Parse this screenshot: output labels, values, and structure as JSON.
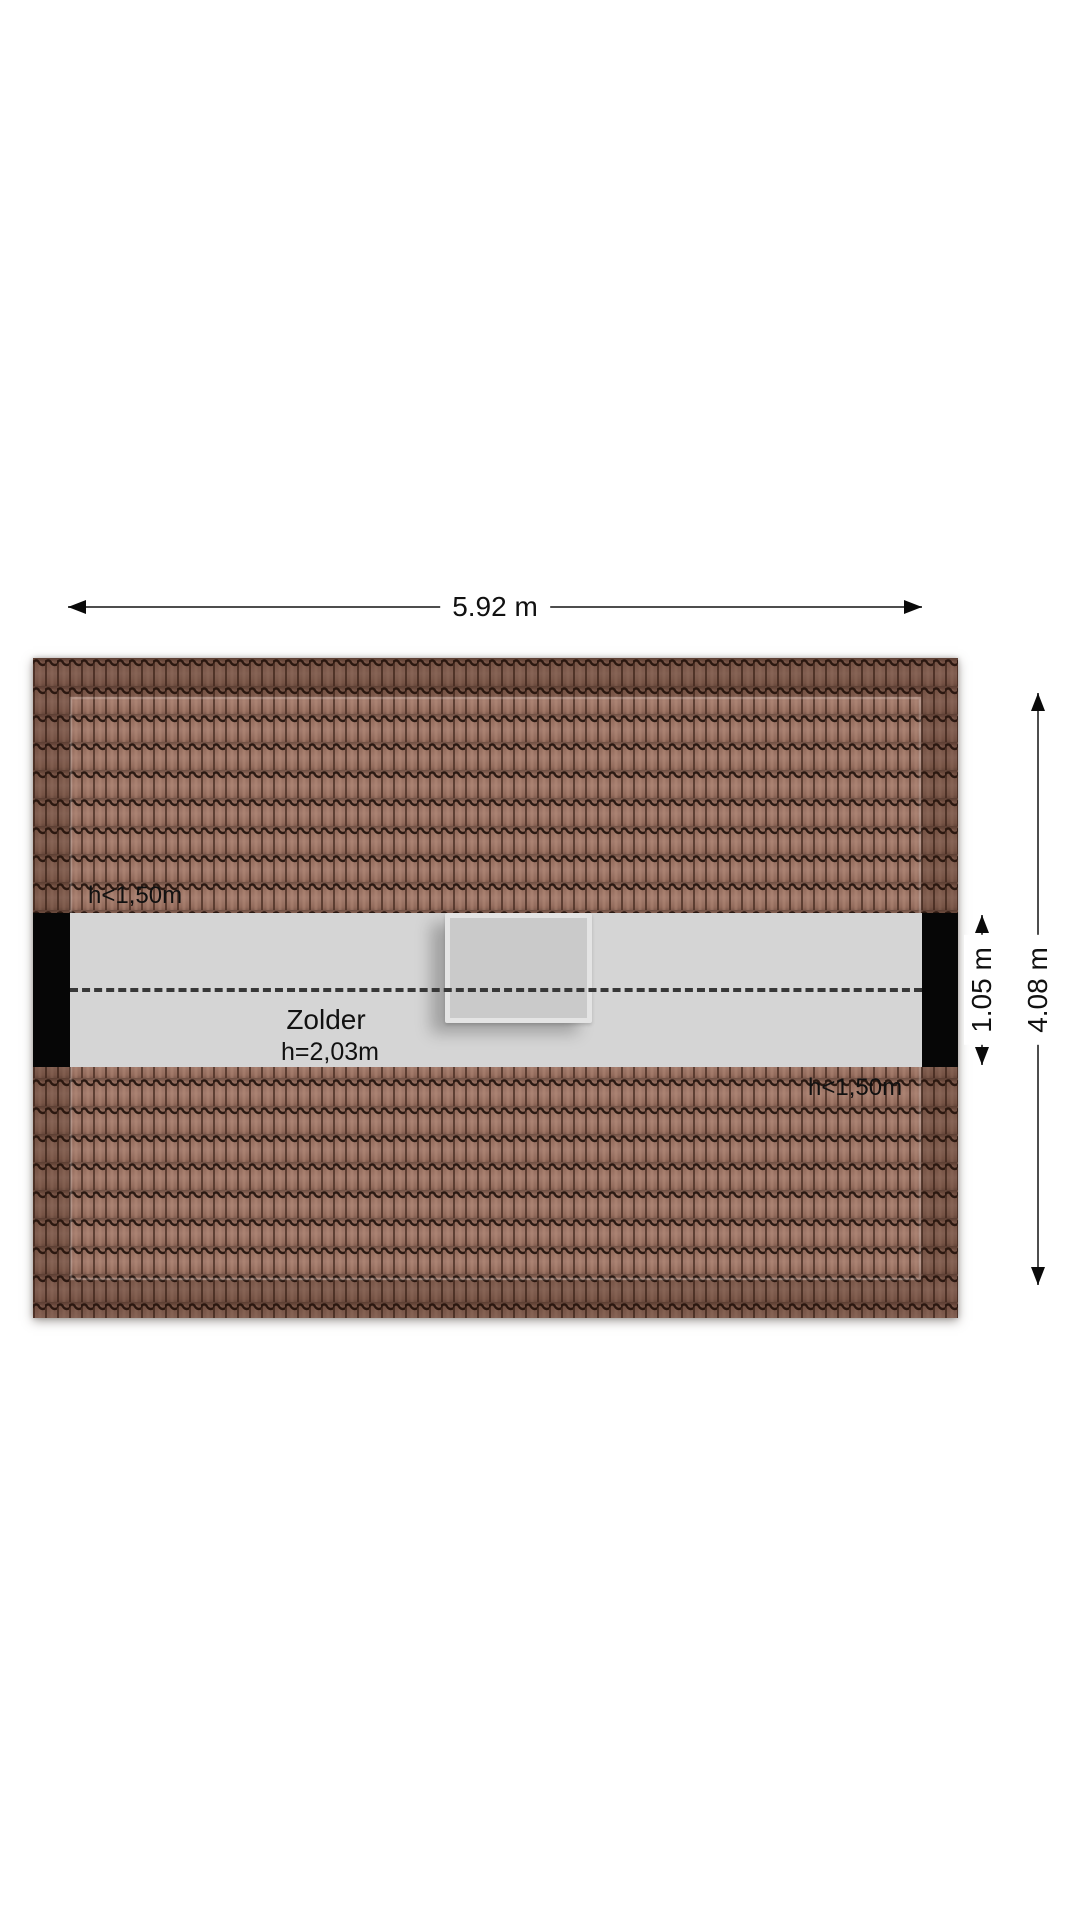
{
  "floorplan": {
    "room": {
      "name": "Zolder",
      "ceiling_height": "h=2,03m"
    },
    "low_headroom": {
      "top": "h<1,50m",
      "bottom": "h<1,50m"
    },
    "dimensions": {
      "total_width": "5.92 m",
      "total_depth": "4.08 m",
      "floor_strip_depth": "1.05 m"
    },
    "colors": {
      "roof_tile": "#9c7262",
      "tile_line": "#2b1a13",
      "floor": "#d5d5d5",
      "wall": "#060606",
      "dimension_line": "#4d4d4d",
      "text": "#111111",
      "skylight_fill": "#cacaca",
      "skylight_frame": "#e4e4e4"
    }
  }
}
